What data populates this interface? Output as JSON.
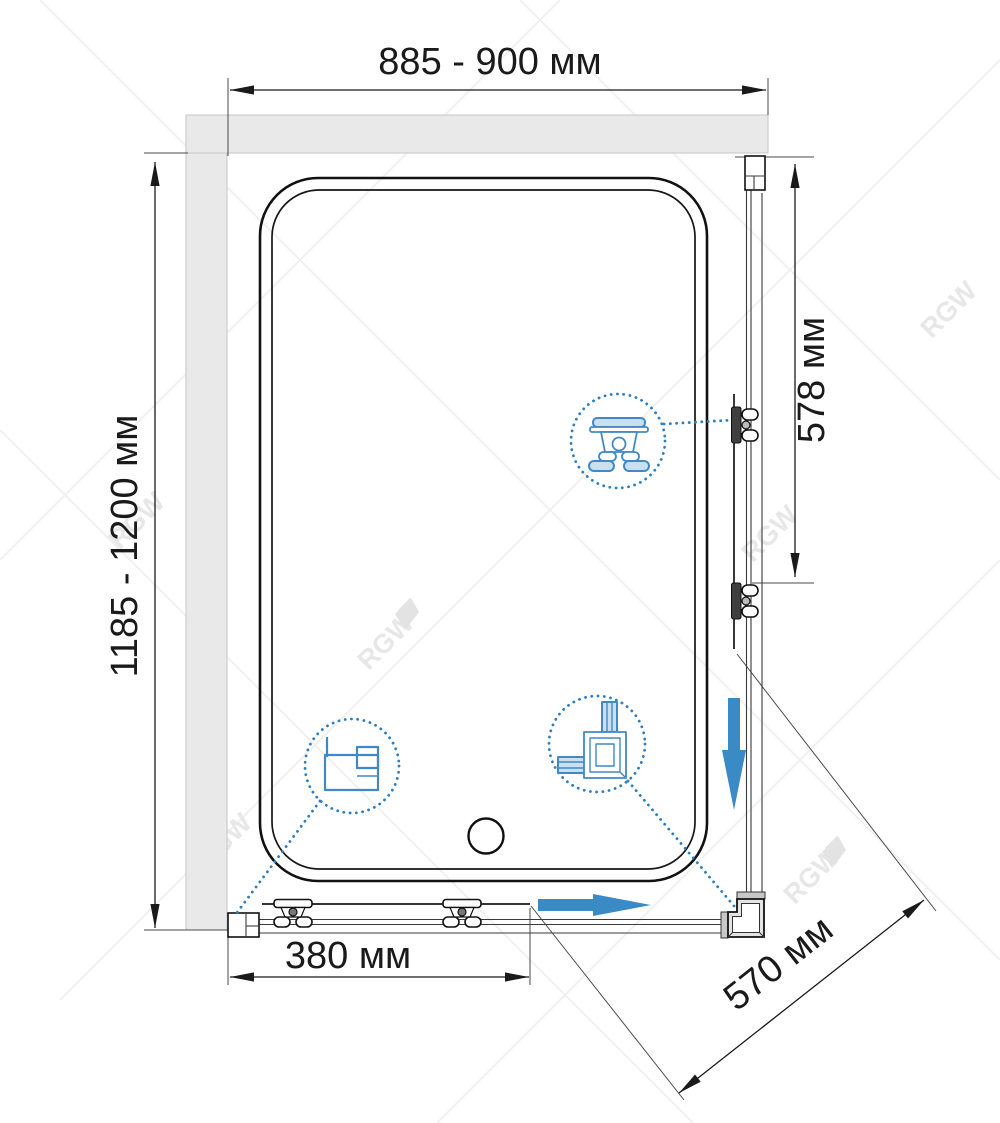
{
  "title": "Shower enclosure dimensional drawing (top view)",
  "watermark": {
    "text": "RGW"
  },
  "dimensions": {
    "top_width": "885 - 900 мм",
    "left_height": "1185 - 1200 мм",
    "right_side": "578 мм",
    "bottom_door": "380 мм",
    "diagonal_entry": "570 мм"
  },
  "colors": {
    "accent_blue": "#3a8ac5",
    "detail_blue": "#2e7fc0",
    "wall_gray": "#e9e9e9",
    "line_black": "#1a1a1a",
    "watermark_gray": "#e7e7e7"
  },
  "callouts": {
    "roller": "roller-carriage-detail",
    "wall_profile": "wall-profile-detail",
    "corner": "corner-connector-detail"
  }
}
